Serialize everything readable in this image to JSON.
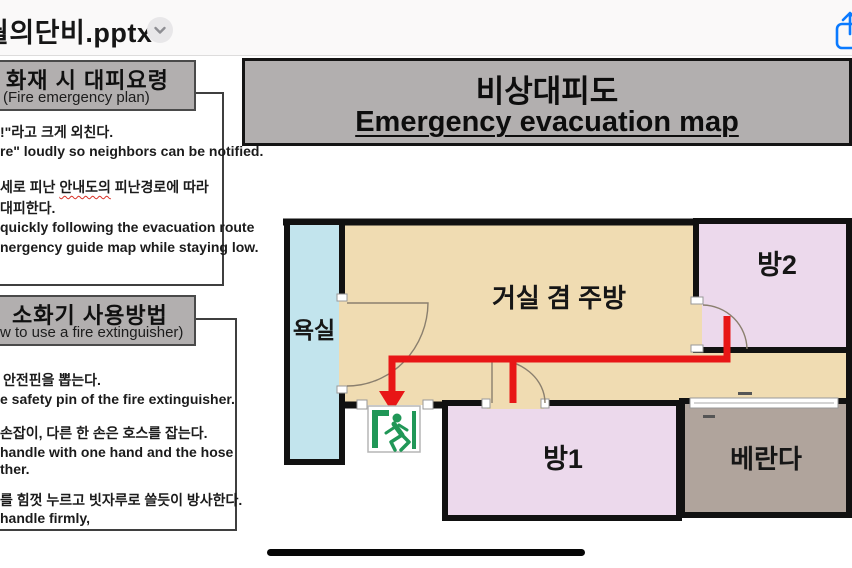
{
  "titlebar": {
    "filename": "월의단비.pptx",
    "icons": {
      "chevron": "chevron-down-icon",
      "share": "share-icon"
    }
  },
  "colors": {
    "accent_blue": "#0a7aff",
    "box_gray": "#b2afaf",
    "wall": "#111111",
    "route_red": "#e81616",
    "exit_green": "#209757",
    "bathroom": "#c2e4ed",
    "living": "#f0dcb2",
    "room_pink": "#ecd9ec",
    "veranda": "#b0a49c"
  },
  "left_panel": {
    "section1": {
      "title_ko": "화재 시 대피요령",
      "title_en": "(Fire emergency plan)",
      "para1": [
        "!\"라고 크게 외친다.",
        "re\" loudly so neighbors can be notified."
      ],
      "para2_pre": "세로 피난 ",
      "para2_marked": "안내도의",
      "para2_post": " 피난경로에 따라",
      "para2_lines": [
        "대피한다.",
        "quickly following the evacuation route",
        "nergency guide map while staying low."
      ]
    },
    "section2": {
      "title_ko": "소화기 사용방법",
      "title_en": "w to use a fire extinguisher)",
      "paraA": [
        "안전핀을 뽑는다.",
        "e safety pin of the fire extinguisher."
      ],
      "paraB": [
        "손잡이, 다른 한 손은 호스를 잡는다.",
        "handle with one hand and the hose",
        "ther."
      ],
      "paraC": [
        "를 힘껏 누르고 빗자루로 쓸듯이 방사한다.",
        "handle firmly,"
      ]
    }
  },
  "slide": {
    "title_ko": "비상대피도",
    "title_en": "Emergency evacuation map"
  },
  "floorplan": {
    "rooms": {
      "bathroom": "욕실",
      "living": "거실 겸 주방",
      "room2": "방2",
      "room1": "방1",
      "veranda": "베란다"
    },
    "icons": {
      "exit": "running-man-exit-icon"
    }
  }
}
